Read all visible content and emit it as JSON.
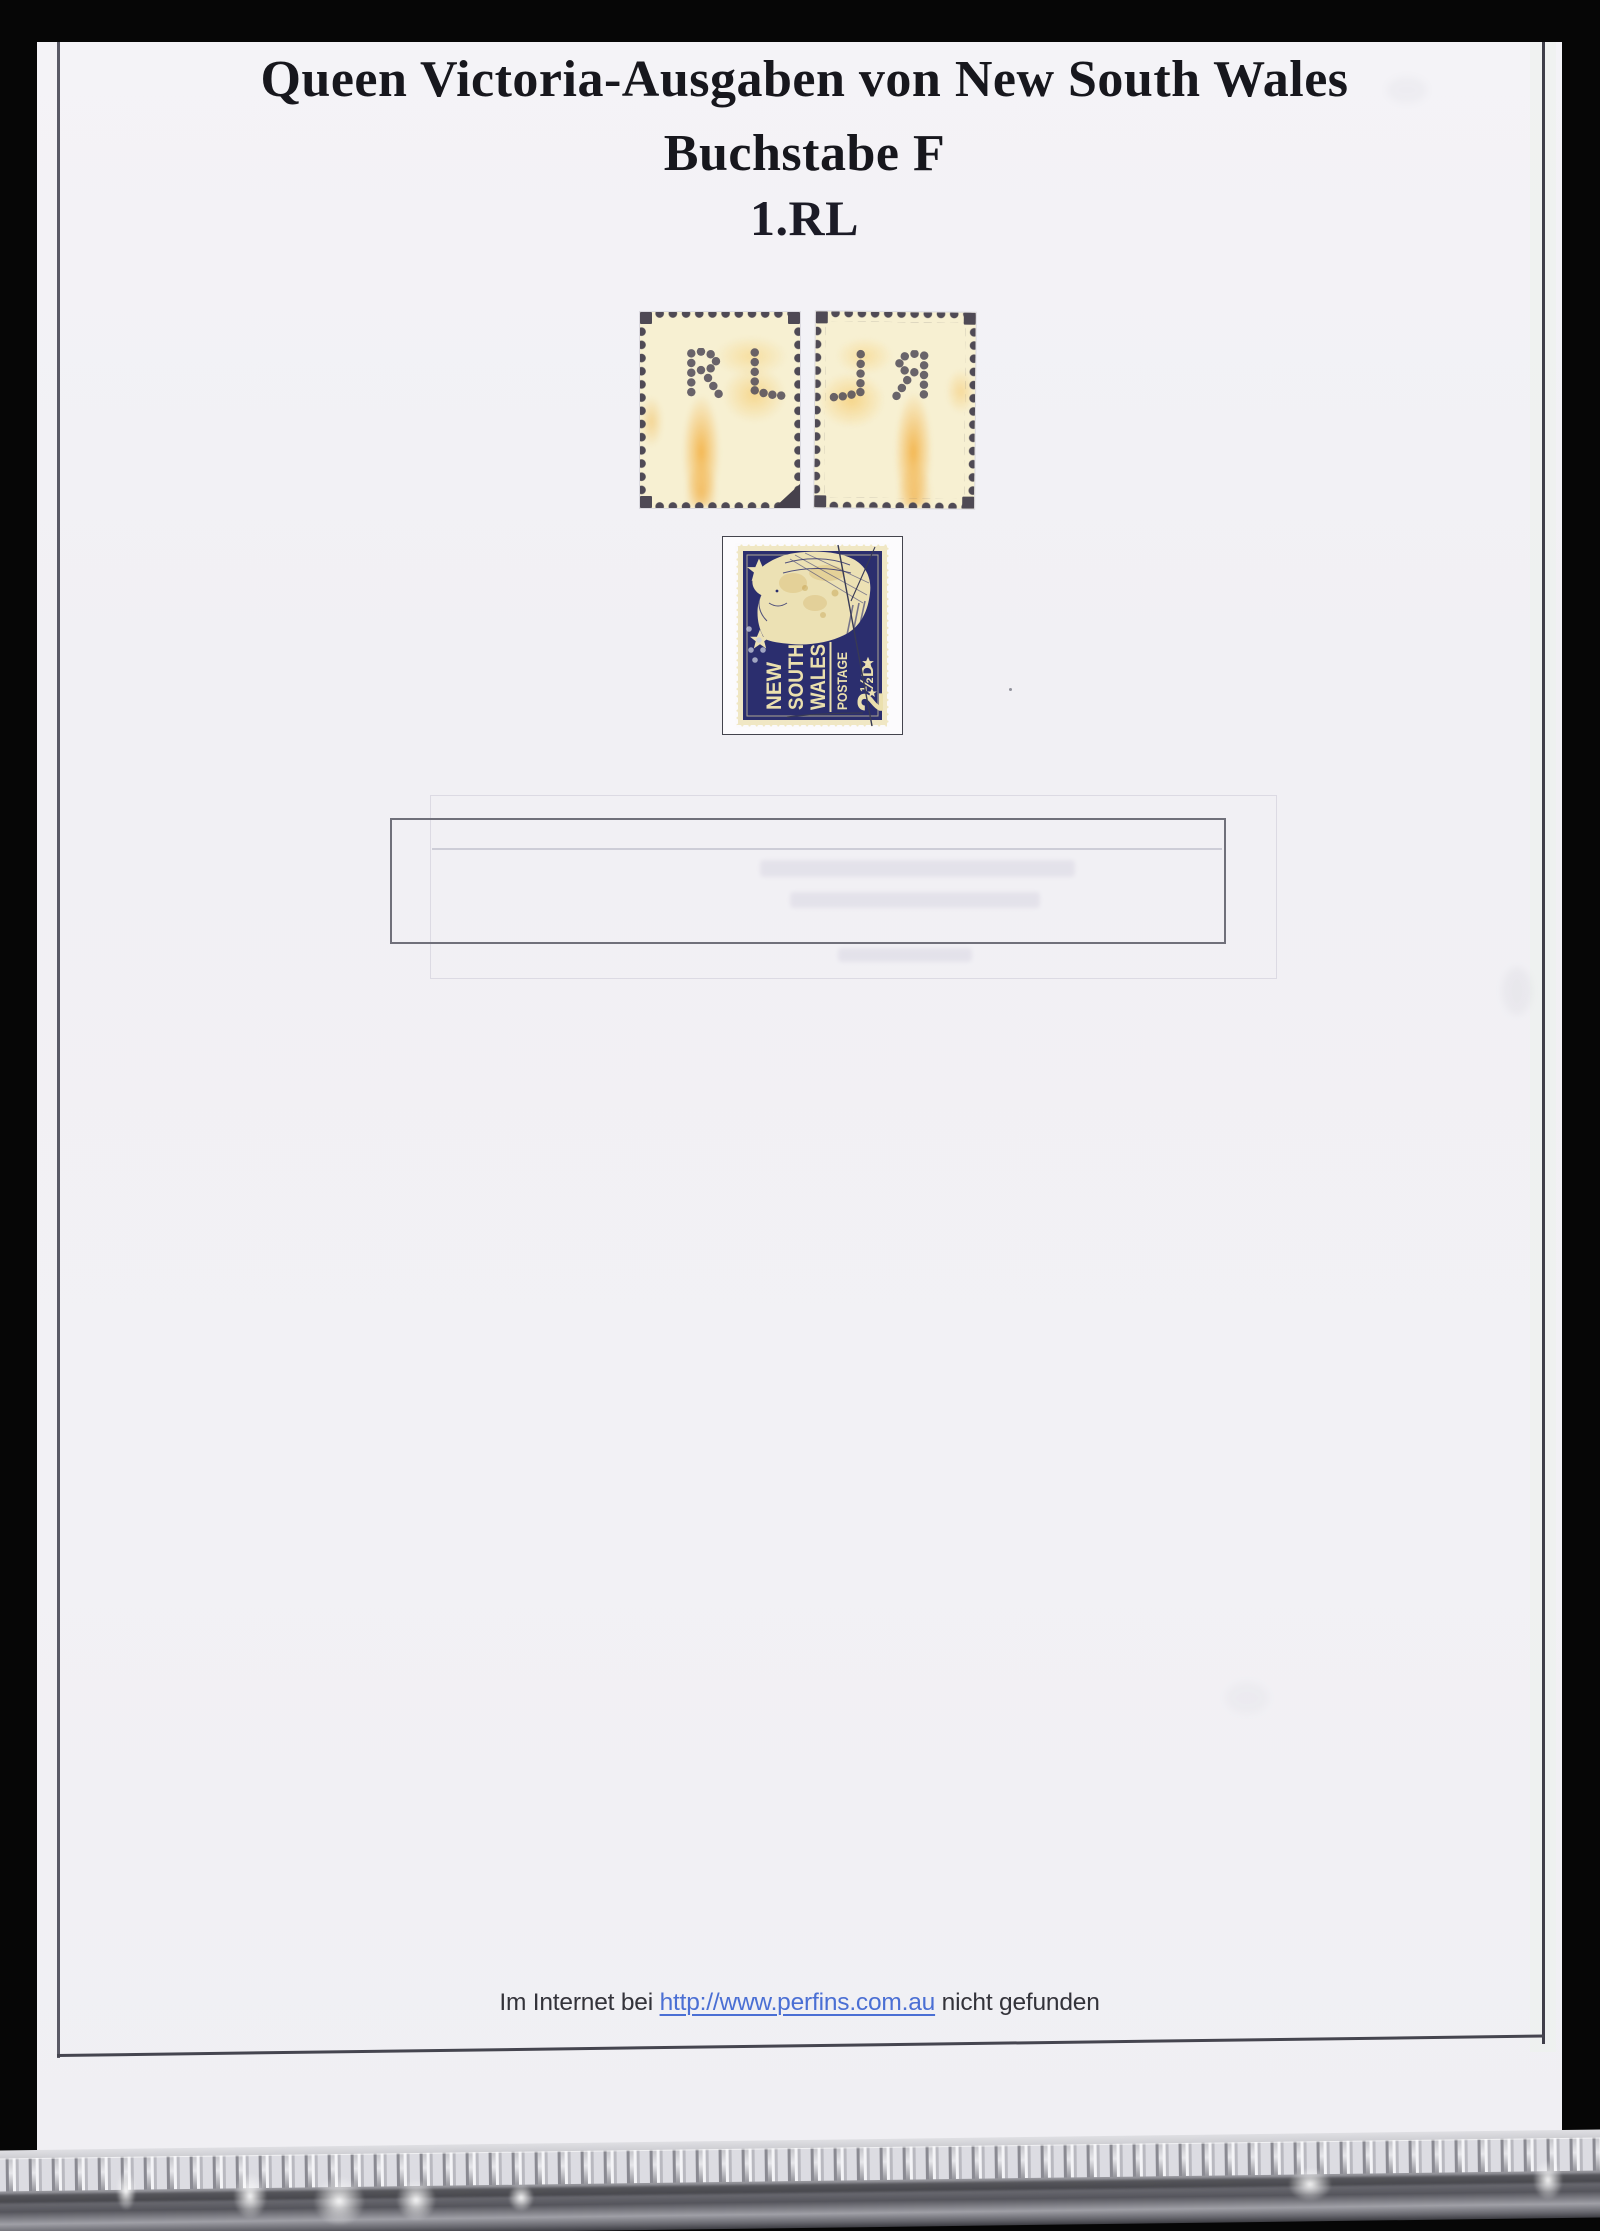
{
  "scan": {
    "title_line1": "Queen Victoria-Ausgaben von New South Wales",
    "title_line2": "Buchstabe F",
    "section_heading": "1.RL",
    "footer_prefix": "Im Internet bei ",
    "footer_link": "http://www.perfins.com.au",
    "footer_suffix": " nicht gefunden"
  },
  "stamps": {
    "perfin_letters": "RL",
    "nsw_stamp": {
      "line1": "NEW",
      "line2": "SOUTH",
      "line3": "WALES",
      "postage": "POSTAGE",
      "value_main": "2",
      "value_fraction": "½",
      "value_unit": "D"
    }
  },
  "colors": {
    "scanner_background": "#060606",
    "page": "#f2f1f5",
    "title_text": "#17171d",
    "link_blue": "#4a6fd4",
    "stamp_navy": "#2b2e6e",
    "stamp_cream": "#f0e7c4",
    "perfin_dot": "#56505c",
    "stain_orange": "#f2a830"
  }
}
